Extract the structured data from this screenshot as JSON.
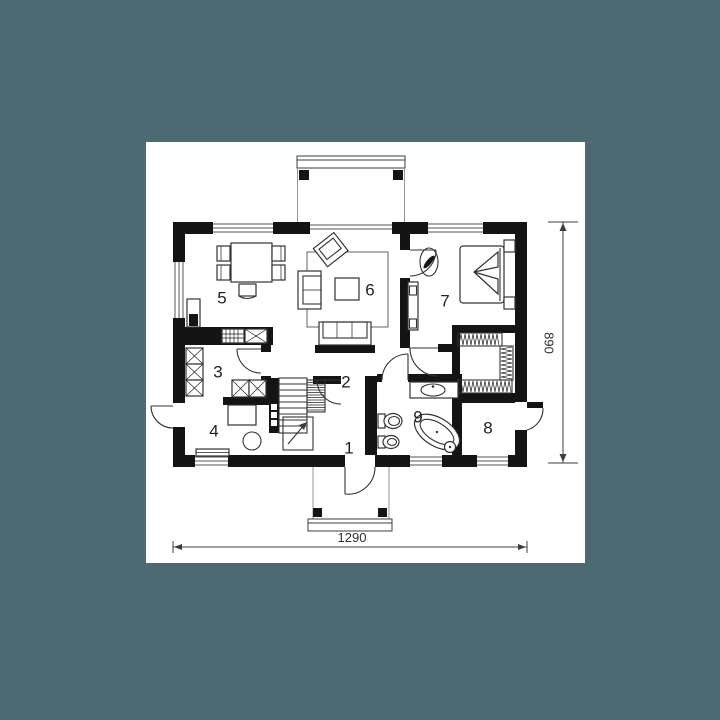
{
  "colors": {
    "background": "#4d6a72",
    "sheet": "#ffffff",
    "walls": "#141414",
    "lines": "#3c3c3c"
  },
  "rooms": [
    {
      "number": "1"
    },
    {
      "number": "2"
    },
    {
      "number": "3"
    },
    {
      "number": "4"
    },
    {
      "number": "5"
    },
    {
      "number": "6"
    },
    {
      "number": "7"
    },
    {
      "number": "8"
    },
    {
      "number": "9"
    }
  ],
  "dimensions": {
    "width": "1290",
    "height": "890"
  },
  "icons": [
    "dining-table",
    "dining-chair",
    "kitchen-counter",
    "stove",
    "sink-unit",
    "cabinet-x",
    "rug",
    "armchair",
    "sofa",
    "coffee-table",
    "double-bed",
    "nightstand",
    "dresser",
    "wardrobe",
    "clothes-rail",
    "stairs",
    "stair-arrow",
    "washbasin",
    "toilet",
    "bidet",
    "bathtub",
    "terrace",
    "porch",
    "window",
    "door-swing"
  ]
}
